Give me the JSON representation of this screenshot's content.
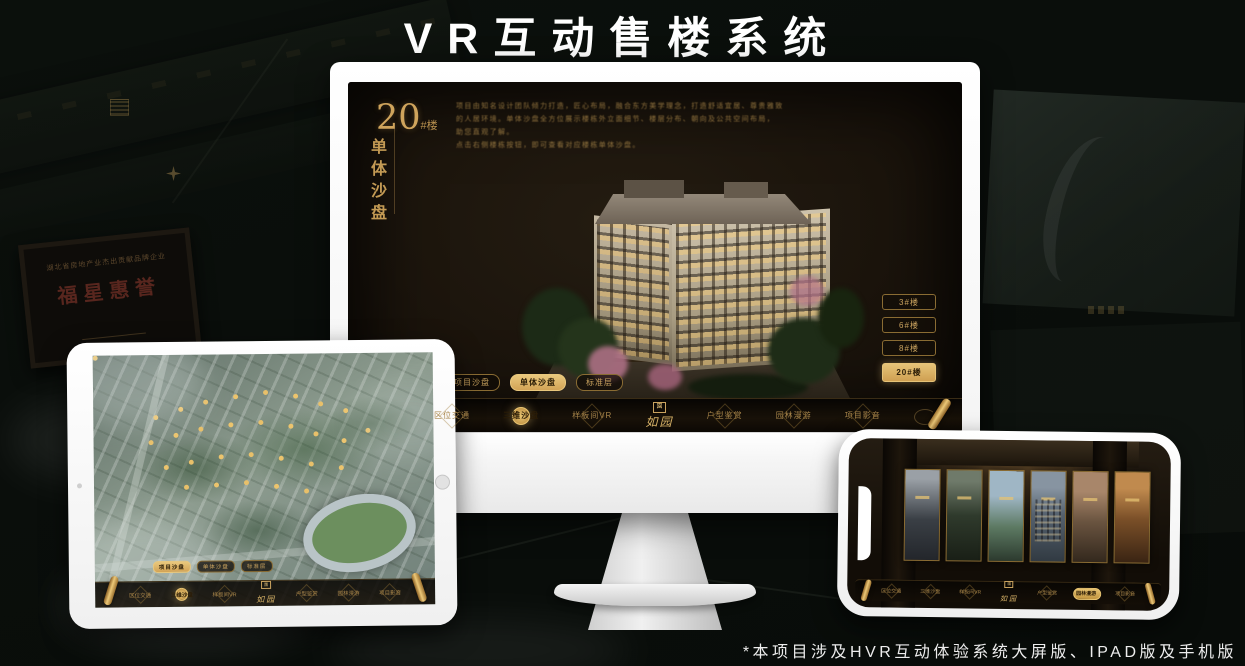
{
  "page": {
    "title": "VR互动售楼系统",
    "footnote": "*本项目涉及HVR互动体验系统大屏版、IPAD版及手机版"
  },
  "colors": {
    "gold": "#c9a05a",
    "gold_bright": "#e8c472",
    "screen_dark": "#1b140c",
    "background": "#0a0e0b",
    "device_white": "#ffffff"
  },
  "background": {
    "plaque_small_text": "湖北省房地产业杰出贡献品牌企业",
    "plaque_brand": "福星惠誉"
  },
  "monitor_app": {
    "block_number": "20",
    "block_suffix": "#楼",
    "block_subtitle": "单体沙盘",
    "description_lines": [
      "项目由知名设计团队倾力打造，匠心布局，融合东方美学理念，打造舒适宜居、尊贵雅致",
      "的人居环境。单体沙盘全方位展示楼栋外立面细节、楼层分布、朝向及公共空间布局，",
      "助您直观了解。",
      "点击右侧楼栋按钮，即可查看对应楼栋单体沙盘。"
    ],
    "building_buttons": [
      {
        "label": "3#楼",
        "active": false
      },
      {
        "label": "6#楼",
        "active": false
      },
      {
        "label": "8#楼",
        "active": false
      },
      {
        "label": "20#楼",
        "active": true
      }
    ],
    "view_tabs": [
      {
        "label": "项目沙盘",
        "active": false
      },
      {
        "label": "单体沙盘",
        "active": true
      },
      {
        "label": "标准层",
        "active": false
      }
    ],
    "nav": {
      "items": [
        {
          "label": "区位交通",
          "active": false
        },
        {
          "label": "三维沙盘",
          "active": true
        },
        {
          "label": "样板间VR",
          "active": false
        },
        {
          "label": "户型鉴赏",
          "active": false
        },
        {
          "label": "园林漫游",
          "active": false
        },
        {
          "label": "项目影音",
          "active": false
        }
      ],
      "logo": {
        "seal": "園",
        "name": "如园"
      }
    }
  },
  "ipad_app": {
    "view_tabs": [
      {
        "label": "项目沙盘",
        "active": true
      },
      {
        "label": "单体沙盘",
        "active": false
      },
      {
        "label": "标准层",
        "active": false
      }
    ],
    "nav": {
      "items": [
        {
          "label": "区位交通",
          "active": false
        },
        {
          "label": "三维沙盘",
          "active": true
        },
        {
          "label": "样板间VR",
          "active": false
        },
        {
          "label": "户型鉴赏",
          "active": false
        },
        {
          "label": "园林漫游",
          "active": false
        },
        {
          "label": "项目影音",
          "active": false
        }
      ],
      "logo": {
        "seal": "園",
        "name": "如园"
      }
    }
  },
  "phone_app": {
    "gallery_count": 6,
    "nav": {
      "items": [
        {
          "label": "区位交通",
          "active": false
        },
        {
          "label": "三维沙盘",
          "active": false
        },
        {
          "label": "样板间VR",
          "active": false
        },
        {
          "label": "户型鉴赏",
          "active": false
        },
        {
          "label": "园林漫游",
          "active": true
        },
        {
          "label": "项目影音",
          "active": false
        }
      ],
      "logo": {
        "seal": "園",
        "name": "如园"
      }
    }
  }
}
